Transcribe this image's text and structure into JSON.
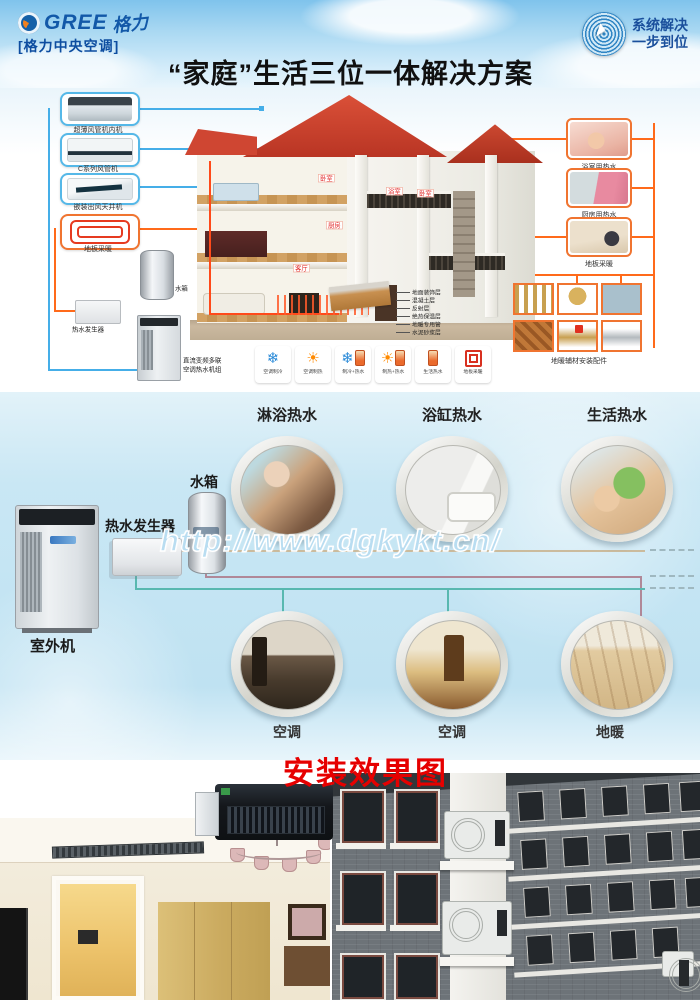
{
  "header": {
    "brand": "GREE",
    "brand_script": "格力",
    "brand_sub": "[格力中央空调]",
    "title": "“家庭”生活三位一体解决方案",
    "badge_line1": "系统解决",
    "badge_line2": "一步到位"
  },
  "diagram": {
    "indoor_units": [
      {
        "label": "超薄风管机内机"
      },
      {
        "label": "C系列风管机"
      },
      {
        "label": "嵌装出风天井机"
      },
      {
        "label": "地板采暖"
      }
    ],
    "equipment": {
      "tank": "水箱",
      "generator": "热水发生器",
      "outdoor1": "直流变频多联",
      "outdoor2": "空调热水机组"
    },
    "rooms": [
      "卧室",
      "浴室",
      "卧室",
      "厨房",
      "客厅"
    ],
    "usage": [
      {
        "label": "浴室用热水"
      },
      {
        "label": "厨房用热水"
      },
      {
        "label": "地板采暖"
      }
    ],
    "floor_layers": [
      "地面装饰层",
      "混凝土层",
      "反射层",
      "绝热保温层",
      "地暖专用管",
      "水泥砂浆层"
    ],
    "parts_caption": "地暖辅材安装配件",
    "modes": [
      {
        "icon": "snowflake",
        "label": "空调制冷"
      },
      {
        "icon": "sun",
        "label": "空调制热"
      },
      {
        "icon": "snowflake-heater",
        "label": "制冷+热水"
      },
      {
        "icon": "sun-heater",
        "label": "制热+热水"
      },
      {
        "icon": "heater",
        "label": "生活热水"
      },
      {
        "icon": "coil",
        "label": "地板采暖"
      }
    ]
  },
  "hotwater": {
    "top": [
      "淋浴热水",
      "浴缸热水",
      "生活热水"
    ],
    "bottom": [
      "空调",
      "空调",
      "地暖"
    ],
    "outdoor": "室外机",
    "generator": "热水发生器",
    "tank": "水箱",
    "watermark": "http://www.dgkykt.cn/"
  },
  "gallery": {
    "title": "安装效果图"
  },
  "colors": {
    "accent_orange": "#f07430",
    "accent_blue": "#45aee8",
    "title_red": "#e60000",
    "brand_blue": "#1258a8"
  }
}
